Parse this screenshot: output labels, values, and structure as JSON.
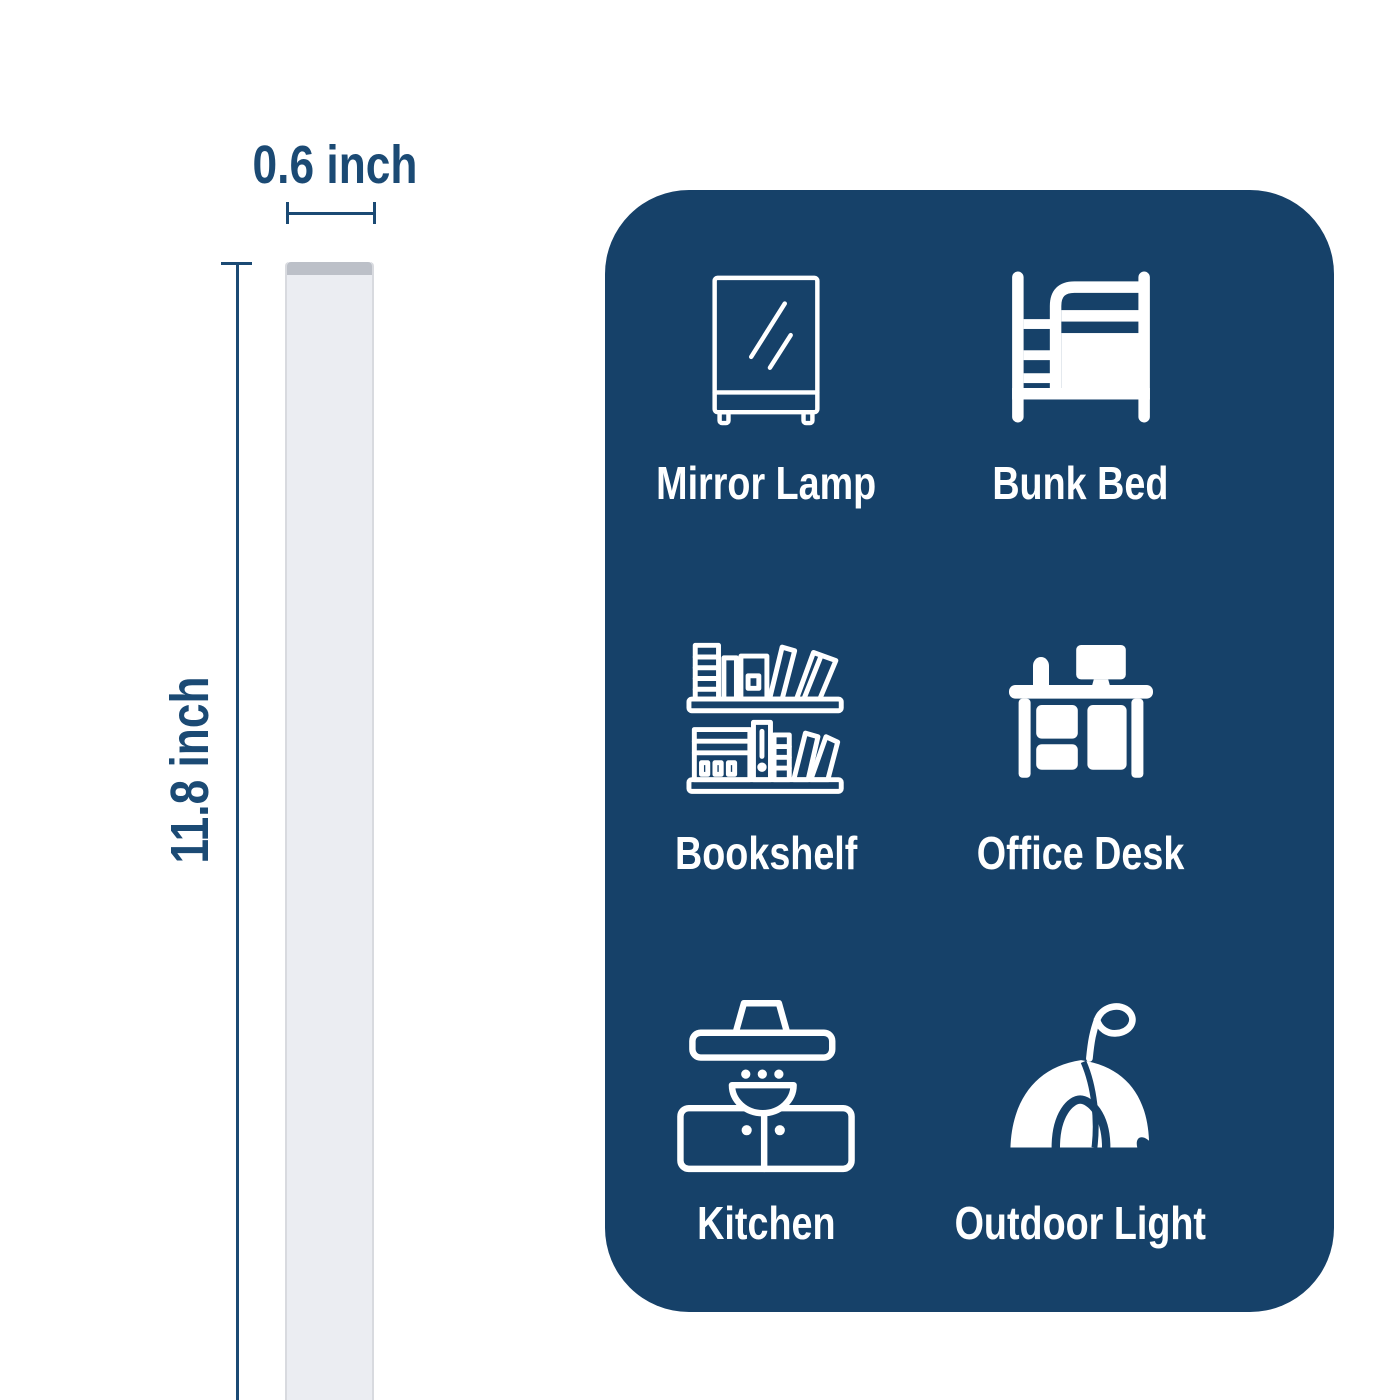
{
  "dimensions": {
    "width_label": "0.6 inch",
    "height_label": "11.8 inch"
  },
  "usage_panel": {
    "items": [
      {
        "label": "Mirror Lamp",
        "icon": "mirror-lamp-icon"
      },
      {
        "label": "Bunk Bed",
        "icon": "bunk-bed-icon"
      },
      {
        "label": "Bookshelf",
        "icon": "bookshelf-icon"
      },
      {
        "label": "Office Desk",
        "icon": "office-desk-icon"
      },
      {
        "label": "Kitchen",
        "icon": "kitchen-icon"
      },
      {
        "label": "Outdoor Light",
        "icon": "outdoor-light-icon"
      }
    ]
  },
  "colors": {
    "panel_bg": "#164169",
    "dim_color": "#1b4a74",
    "icon_white": "#ffffff",
    "bar_fill": "#ebedf2",
    "bar_cap": "#bcc0c8",
    "bar_edge": "#d8dadf",
    "page_bg": "#ffffff"
  }
}
